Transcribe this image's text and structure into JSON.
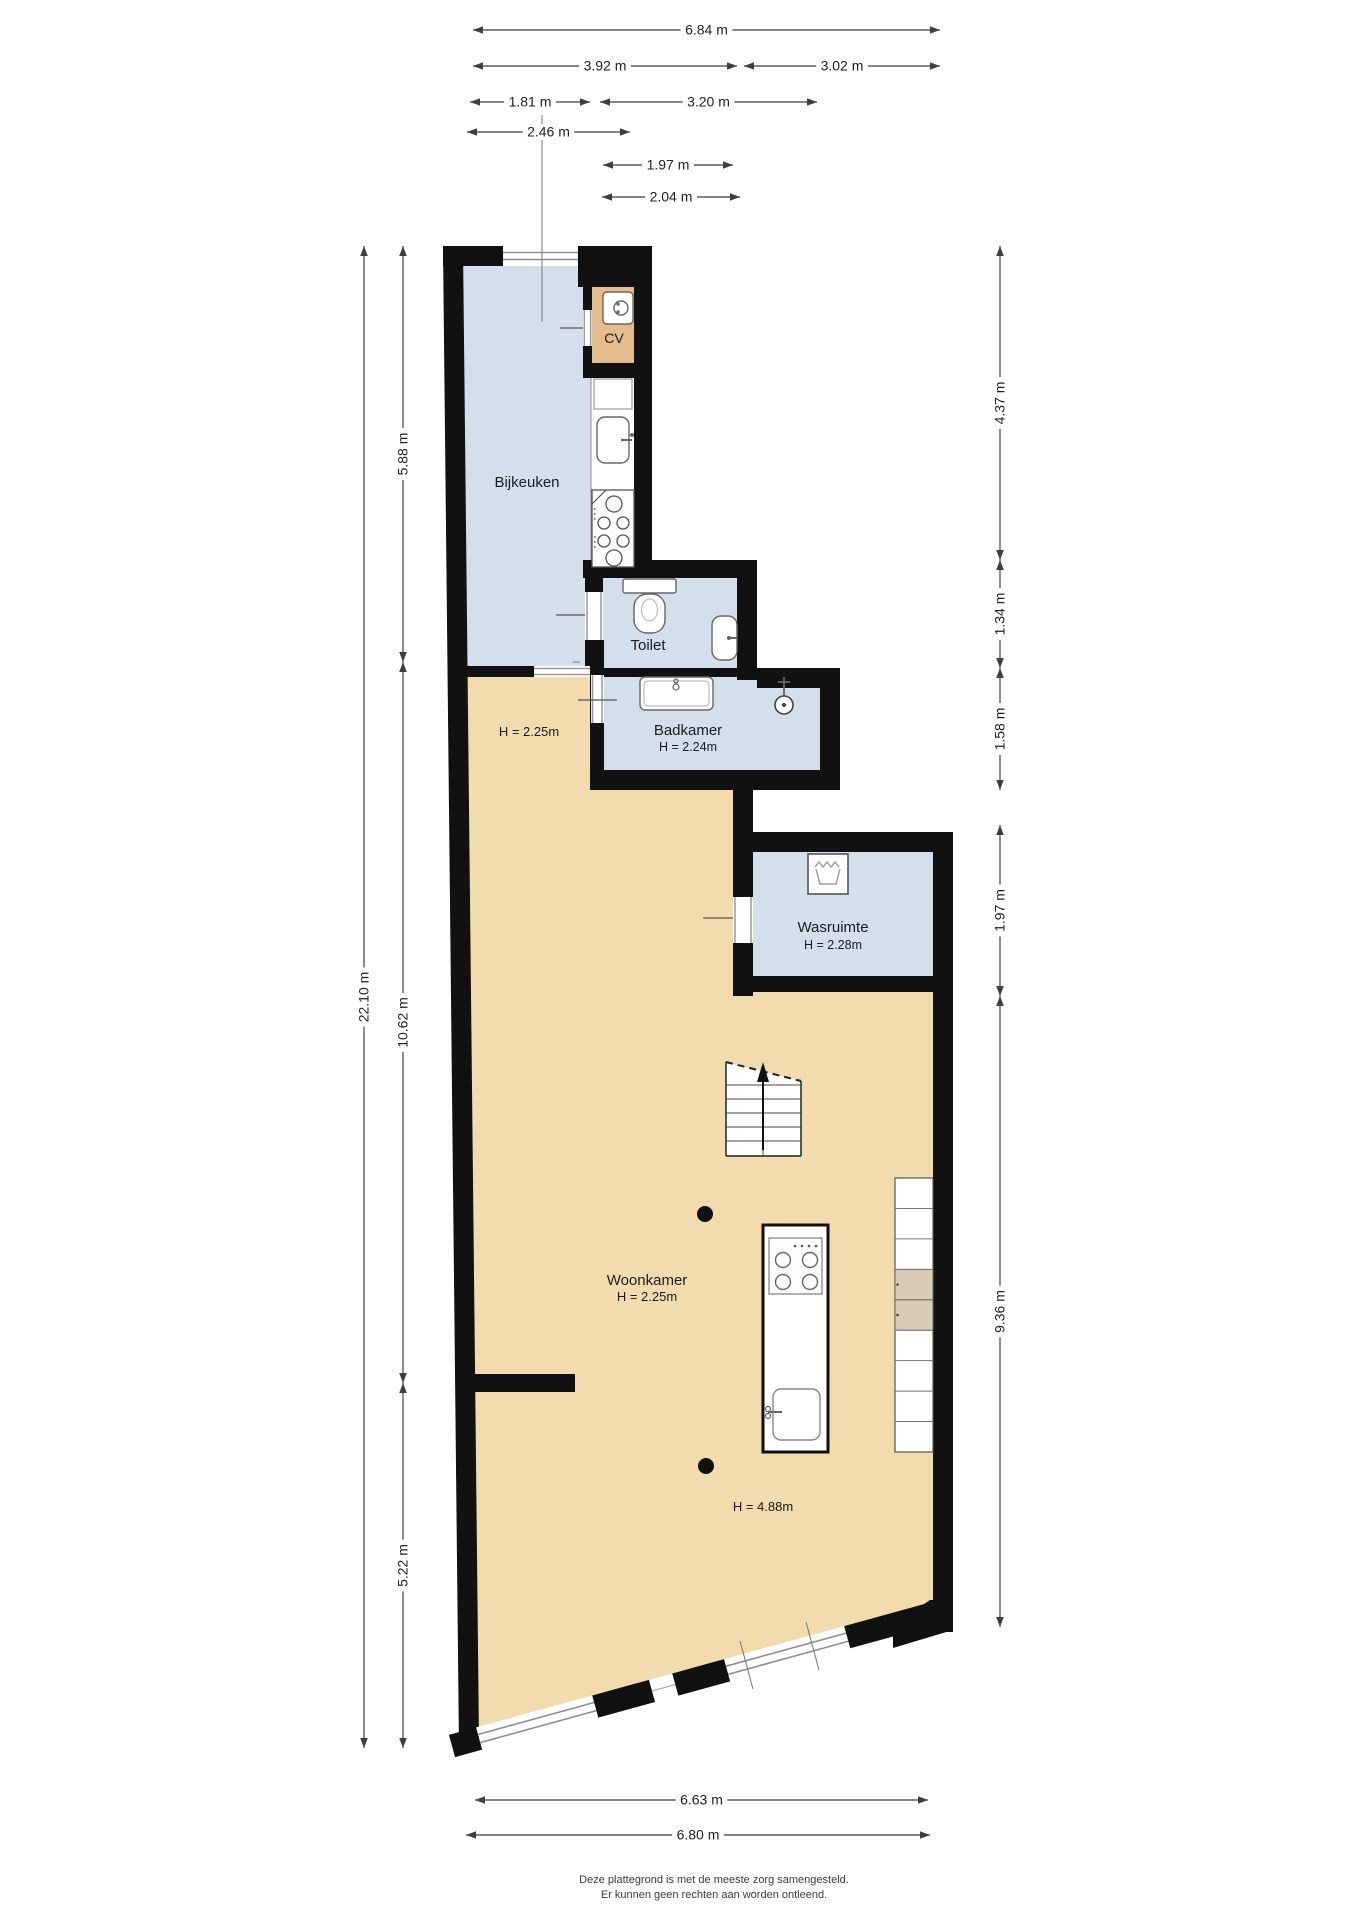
{
  "page": {
    "title": "Plattegrond begane grond",
    "width": 1358,
    "height": 1920
  },
  "palette": {
    "wall": "#111111",
    "room_blue": "#d3e0ec",
    "room_tan": "#f2dcae",
    "cv_tan": "#e5bc8b",
    "shade_tan": "#d9ccb6",
    "dim_line": "#3f3f3f",
    "dim_text": "#222222",
    "fixture_stroke": "#666666",
    "frame_gray": "#999999",
    "footer_text": "#3c3c3c",
    "white": "#ffffff"
  },
  "footer": {
    "line1": "Deze plattegrond is met de meeste zorg samengesteld.",
    "line2": "Er kunnen geen rechten aan worden ontleend.",
    "x": 714,
    "y1": 1883,
    "y2": 1898,
    "size": 11
  },
  "rooms": [
    {
      "name": "room-bijkeuken",
      "fill": "room_blue",
      "poly": [
        [
          463,
          266
        ],
        [
          578,
          266
        ],
        [
          578,
          287
        ],
        [
          591,
          287
        ],
        [
          591,
          666
        ],
        [
          467,
          666
        ]
      ]
    },
    {
      "name": "room-cv",
      "fill": "cv_tan",
      "rect": [
        592,
        287,
        42,
        76
      ]
    },
    {
      "name": "kitchen-counter-strip",
      "fill": "white",
      "rect": [
        591,
        377,
        43,
        190
      ]
    },
    {
      "name": "room-toilet",
      "fill": "room_blue",
      "rect": [
        602,
        578,
        135,
        90
      ]
    },
    {
      "name": "room-badkamer",
      "fill": "room_blue",
      "rect": [
        604,
        677,
        216,
        93
      ]
    },
    {
      "name": "room-wasruimte",
      "fill": "room_blue",
      "rect": [
        753,
        852,
        180,
        124
      ]
    },
    {
      "name": "room-woonkamer",
      "fill": "room_tan",
      "poly": [
        [
          467,
          677
        ],
        [
          590,
          677
        ],
        [
          590,
          790
        ],
        [
          733,
          790
        ],
        [
          733,
          992
        ],
        [
          933,
          992
        ],
        [
          933,
          1612
        ],
        [
          474,
          1734
        ]
      ]
    }
  ],
  "walls": [
    {
      "name": "wall-top",
      "rect": [
        443,
        246,
        209,
        20
      ]
    },
    {
      "name": "wall-left",
      "poly": [
        [
          443,
          246
        ],
        [
          463,
          246
        ],
        [
          479,
          1742
        ],
        [
          459,
          1748
        ]
      ]
    },
    {
      "name": "wall-cv-top",
      "rect": [
        578,
        266,
        74,
        21
      ]
    },
    {
      "name": "wall-right-strip",
      "rect": [
        634,
        266,
        18,
        312
      ]
    },
    {
      "name": "wall-cv-left",
      "rect": [
        583,
        287,
        9,
        76
      ]
    },
    {
      "name": "wall-cv-bottom",
      "rect": [
        583,
        363,
        51,
        15
      ]
    },
    {
      "name": "wall-toilet-top",
      "rect": [
        583,
        560,
        174,
        18
      ]
    },
    {
      "name": "wall-toilet-left",
      "rect": [
        585,
        578,
        18,
        95
      ]
    },
    {
      "name": "wall-toilet-right",
      "rect": [
        737,
        560,
        20,
        120
      ]
    },
    {
      "name": "wall-toilet-bottom",
      "rect": [
        602,
        668,
        155,
        9
      ]
    },
    {
      "name": "wall-badkamer-ext-top",
      "rect": [
        757,
        668,
        83,
        20
      ]
    },
    {
      "name": "wall-badkamer-right",
      "rect": [
        820,
        686,
        20,
        104
      ]
    },
    {
      "name": "wall-badkamer-bottom",
      "rect": [
        590,
        770,
        250,
        20
      ]
    },
    {
      "name": "wall-badkamer-left",
      "rect": [
        590,
        640,
        14,
        130
      ]
    },
    {
      "name": "wall-bijkeuken-bottom",
      "rect": [
        452,
        666,
        82,
        11
      ]
    },
    {
      "name": "wall-hal-wasruimte",
      "rect": [
        733,
        790,
        20,
        206
      ]
    },
    {
      "name": "wall-wasruimte-top",
      "rect": [
        733,
        832,
        220,
        20
      ]
    },
    {
      "name": "wall-right-lower",
      "rect": [
        933,
        832,
        20,
        800
      ]
    },
    {
      "name": "wall-wasruimte-bottom",
      "rect": [
        753,
        976,
        180,
        16
      ]
    },
    {
      "name": "wall-stub-left",
      "rect": [
        463,
        1374,
        112,
        18
      ]
    },
    {
      "name": "wall-corner-bottom-right",
      "poly": [
        [
          893,
          1648
        ],
        [
          953,
          1630
        ],
        [
          953,
          1600
        ],
        [
          930,
          1600
        ],
        [
          893,
          1625
        ]
      ]
    }
  ],
  "windows": [
    {
      "name": "window-bijkeuken-top",
      "rect": [
        503,
        246,
        75,
        20
      ],
      "lines": [
        [
          503,
          252.5,
          578,
          252.5
        ],
        [
          503,
          259.5,
          578,
          259.5
        ]
      ]
    }
  ],
  "openings": [
    {
      "name": "door-cv",
      "gap": [
        583,
        310,
        9,
        36
      ],
      "frames": [
        [
          584.3,
          310,
          584.3,
          346
        ],
        [
          590.7,
          310,
          590.7,
          346
        ]
      ],
      "leaf": [
        560,
        328,
        583,
        328
      ]
    },
    {
      "name": "door-toilet",
      "gap": [
        585,
        592,
        18,
        48
      ],
      "frames": [
        [
          587,
          592,
          587,
          640
        ],
        [
          601,
          592,
          601,
          640
        ]
      ],
      "leaf": [
        556,
        615,
        585,
        615
      ]
    },
    {
      "name": "door-badkamer",
      "gap": [
        591,
        675,
        13,
        48
      ],
      "frames": [
        [
          592.5,
          675,
          592.5,
          723
        ],
        [
          602,
          675,
          602,
          723
        ]
      ],
      "leaf": [
        578,
        700,
        617,
        700
      ]
    },
    {
      "name": "door-wasruimte",
      "gap": [
        733,
        897,
        20,
        46
      ],
      "frames": [
        [
          735,
          897,
          735,
          943
        ],
        [
          751,
          897,
          751,
          943
        ]
      ],
      "leaf": [
        703,
        918,
        733,
        918
      ]
    },
    {
      "name": "opening-bijkeuken-hal",
      "gap": [
        534,
        666,
        56,
        11
      ],
      "frames": [
        [
          534,
          668.5,
          590,
          668.5
        ],
        [
          534,
          674.5,
          590,
          674.5
        ]
      ],
      "leaf": null
    }
  ],
  "bottom_band": {
    "p1": [
      452,
      1746
    ],
    "p2": [
      946,
      1610
    ],
    "width": 23,
    "segments": [
      {
        "t0": 0.0,
        "t1": 0.055,
        "kind": "wall"
      },
      {
        "t0": 0.055,
        "t1": 0.29,
        "kind": "window"
      },
      {
        "t0": 0.29,
        "t1": 0.405,
        "kind": "wall"
      },
      {
        "t0": 0.405,
        "t1": 0.452,
        "kind": "gap"
      },
      {
        "t0": 0.452,
        "t1": 0.557,
        "kind": "wall"
      },
      {
        "t0": 0.557,
        "t1": 0.8,
        "kind": "window"
      },
      {
        "t0": 0.8,
        "t1": 1.0,
        "kind": "wall"
      }
    ]
  },
  "stairs": {
    "name": "staircase",
    "poly": [
      [
        726,
        1062
      ],
      [
        801,
        1081
      ],
      [
        801,
        1156
      ],
      [
        726,
        1156
      ]
    ],
    "dashed_top": [
      726,
      1062,
      801,
      1081
    ],
    "treads": [
      1085,
      1099,
      1113,
      1127,
      1141
    ],
    "rail_x": 763,
    "rail_y1": 1072,
    "rail_y2": 1156,
    "arrow": {
      "x": 763,
      "y1": 1150,
      "y2": 1074,
      "head": [
        [
          763,
          1062
        ],
        [
          757,
          1082
        ],
        [
          769,
          1082
        ]
      ]
    }
  },
  "shelf_strip": {
    "name": "shelf-strip",
    "x": 895,
    "y": 1178,
    "w": 38,
    "h": 274,
    "cells": 9,
    "shaded": [
      3,
      4
    ]
  },
  "columns": [
    [
      705,
      1214,
      8
    ],
    [
      706,
      1466,
      8
    ]
  ],
  "fixtures": {
    "boiler": {
      "name": "boiler-icon",
      "rect": [
        603,
        292,
        30,
        32
      ],
      "circle": [
        621,
        308,
        7
      ],
      "dots": [
        [
          618,
          304
        ],
        [
          618,
          312
        ]
      ]
    },
    "cupboard": {
      "name": "kitchen-cupboard",
      "rect": [
        594,
        379,
        38,
        30
      ]
    },
    "counter_sink": {
      "name": "kitchen-sink-icon",
      "basin": [
        597,
        417,
        32,
        46
      ],
      "tap_line": [
        632,
        440,
        621,
        440
      ],
      "tap_dot": [
        632,
        435
      ]
    },
    "counter_stove": {
      "name": "kitchen-stove-icon",
      "rect": [
        592,
        490,
        42,
        77
      ],
      "diag": [
        592,
        504,
        606,
        490
      ],
      "burners": [
        [
          614,
          504,
          8
        ],
        [
          604,
          523,
          6
        ],
        [
          623,
          523,
          6
        ],
        [
          604,
          541,
          6
        ],
        [
          623,
          541,
          6
        ],
        [
          614,
          558,
          8
        ]
      ],
      "knobs": [
        [
          594.8,
          509
        ],
        [
          594.8,
          514
        ],
        [
          594.8,
          519
        ],
        [
          594.8,
          537
        ],
        [
          594.8,
          542
        ],
        [
          594.8,
          547
        ]
      ]
    },
    "toilet": {
      "name": "toilet-icon",
      "tank": [
        623,
        579,
        53,
        14
      ],
      "bowl": [
        634,
        594,
        31,
        39
      ],
      "inner": [
        649.5,
        610,
        8,
        11
      ]
    },
    "corner_sink": {
      "name": "toilet-sink-icon",
      "rect": [
        712,
        616,
        25,
        44
      ],
      "tap_line": [
        737,
        638,
        727,
        638
      ],
      "tap_dot": [
        729,
        638
      ]
    },
    "tub": {
      "name": "bath-icon",
      "rect": [
        640,
        677,
        73,
        33
      ],
      "inner": [
        644,
        681,
        65,
        25
      ],
      "dots": [
        [
          676,
          681,
          2
        ],
        [
          676,
          687,
          3
        ]
      ]
    },
    "shower": {
      "name": "shower-icon",
      "stem": [
        784,
        677,
        784,
        697
      ],
      "bar": [
        778,
        682,
        790,
        682
      ],
      "circle": [
        784,
        705,
        9
      ],
      "dot": [
        784,
        705,
        2
      ]
    },
    "washer": {
      "name": "washing-machine-icon",
      "rect": [
        808,
        854,
        40,
        40
      ],
      "zigzag": [
        [
          815,
          867
        ],
        [
          819,
          862
        ],
        [
          823,
          867
        ],
        [
          827,
          862
        ],
        [
          831,
          867
        ],
        [
          835,
          862
        ],
        [
          839,
          867
        ]
      ],
      "cup": [
        [
          816,
          869
        ],
        [
          820,
          884
        ],
        [
          836,
          884
        ],
        [
          840,
          869
        ]
      ]
    },
    "island": {
      "name": "kitchen-island",
      "rect": [
        763,
        1225,
        65,
        227
      ],
      "stove": {
        "rect": [
          769,
          1238,
          53,
          56
        ],
        "burners": [
          [
            783,
            1260,
            7.5
          ],
          [
            810,
            1260,
            7.5
          ],
          [
            783,
            1282,
            7.5
          ],
          [
            810,
            1282,
            7.5
          ]
        ],
        "dots": [
          [
            795,
            1246
          ],
          [
            802,
            1246
          ],
          [
            809,
            1246
          ],
          [
            816,
            1246
          ]
        ]
      },
      "sink": {
        "rect": [
          773,
          1389,
          47,
          51
        ],
        "tap_dots": [
          [
            768,
            1409
          ],
          [
            768,
            1416
          ]
        ],
        "tap_line": [
          768,
          1412,
          782,
          1412
        ]
      }
    }
  },
  "witness_lines": [
    [
      542,
      115,
      542,
      322
    ],
    [
      740,
      1641,
      753,
      1689
    ],
    [
      806,
      1622,
      819,
      1670
    ],
    [
      573,
      662,
      580,
      662
    ]
  ],
  "dimensions": {
    "horizontal": [
      {
        "name": "dim-684",
        "x1": 473,
        "x2": 940,
        "y": 30,
        "label": "6.84 m"
      },
      {
        "name": "dim-392",
        "x1": 473,
        "x2": 737,
        "y": 66,
        "label": "3.92 m"
      },
      {
        "name": "dim-302",
        "x1": 744,
        "x2": 940,
        "y": 66,
        "label": "3.02 m"
      },
      {
        "name": "dim-181",
        "x1": 470,
        "x2": 590,
        "y": 102,
        "label": "1.81 m"
      },
      {
        "name": "dim-320",
        "x1": 600,
        "x2": 817,
        "y": 102,
        "label": "3.20 m"
      },
      {
        "name": "dim-246",
        "x1": 467,
        "x2": 630,
        "y": 132,
        "label": "2.46 m"
      },
      {
        "name": "dim-197-top",
        "x1": 603,
        "x2": 733,
        "y": 165,
        "label": "1.97 m"
      },
      {
        "name": "dim-204",
        "x1": 602,
        "x2": 740,
        "y": 197,
        "label": "2.04 m"
      },
      {
        "name": "dim-663",
        "x1": 475,
        "x2": 928,
        "y": 1800,
        "label": "6.63 m"
      },
      {
        "name": "dim-680",
        "x1": 466,
        "x2": 930,
        "y": 1835,
        "label": "6.80 m"
      }
    ],
    "vertical": [
      {
        "name": "dim-2210",
        "x": 364,
        "y1": 246,
        "y2": 1748,
        "label": "22.10 m"
      },
      {
        "name": "dim-588",
        "x": 403,
        "y1": 246,
        "y2": 662,
        "label": "5.88 m"
      },
      {
        "name": "dim-1062",
        "x": 403,
        "y1": 662,
        "y2": 1383,
        "label": "10.62 m"
      },
      {
        "name": "dim-522",
        "x": 403,
        "y1": 1383,
        "y2": 1748,
        "label": "5.22 m"
      },
      {
        "name": "dim-437",
        "x": 1000,
        "y1": 246,
        "y2": 560,
        "label": "4.37 m"
      },
      {
        "name": "dim-134",
        "x": 1000,
        "y1": 560,
        "y2": 668,
        "label": "1.34 m"
      },
      {
        "name": "dim-158",
        "x": 1000,
        "y1": 668,
        "y2": 790,
        "label": "1.58 m"
      },
      {
        "name": "dim-197-right",
        "x": 1000,
        "y1": 825,
        "y2": 996,
        "label": "1.97 m"
      },
      {
        "name": "dim-936",
        "x": 1000,
        "y1": 996,
        "y2": 1627,
        "label": "9.36 m"
      }
    ]
  },
  "labels": [
    {
      "name": "label-bijkeuken",
      "text": "Bijkeuken",
      "x": 527,
      "y": 487,
      "size": 15
    },
    {
      "name": "label-cv",
      "text": "CV",
      "x": 614,
      "y": 343,
      "size": 14
    },
    {
      "name": "label-toilet",
      "text": "Toilet",
      "x": 648,
      "y": 650,
      "size": 15
    },
    {
      "name": "label-badkamer",
      "text": "Badkamer",
      "x": 688,
      "y": 735,
      "size": 15
    },
    {
      "name": "label-badkamer-height",
      "text": "H = 2.24m",
      "x": 688,
      "y": 751,
      "size": 12.5
    },
    {
      "name": "label-hal-height",
      "text": "H = 2.25m",
      "x": 529,
      "y": 736,
      "size": 13
    },
    {
      "name": "label-wasruimte",
      "text": "Wasruimte",
      "x": 833,
      "y": 932,
      "size": 15
    },
    {
      "name": "label-wasruimte-height",
      "text": "H = 2.28m",
      "x": 833,
      "y": 949,
      "size": 12.5
    },
    {
      "name": "label-woonkamer",
      "text": "Woonkamer",
      "x": 647,
      "y": 1285,
      "size": 15
    },
    {
      "name": "label-woonkamer-height",
      "text": "H = 2.25m",
      "x": 647,
      "y": 1301,
      "size": 13
    },
    {
      "name": "label-vide-height",
      "text": "H = 4.88m",
      "x": 763,
      "y": 1511,
      "size": 13
    }
  ]
}
